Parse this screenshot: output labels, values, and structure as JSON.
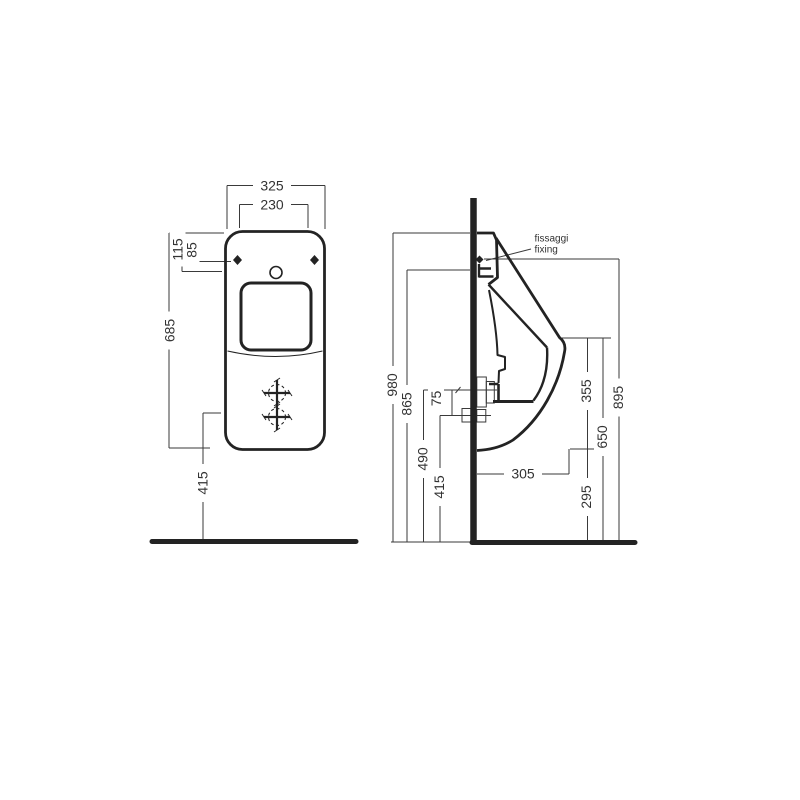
{
  "drawing": {
    "kind": "technical installation drawing",
    "subject": "wall-hung urinal, front and side elevation",
    "background": "#ffffff",
    "line_color": "#232323",
    "dim_line_color": "#3a3a3a"
  },
  "dims": {
    "front": {
      "overall_width": "325",
      "fixing_centers": "230",
      "fixing_offset_1": "115",
      "fixing_offset_2": "85",
      "body_height": "685",
      "outlet_height": "415"
    },
    "side": {
      "overall_height": "980",
      "fixing_height_1": "865",
      "fixing_height_2": "895",
      "inlet_outlet_gap": "75",
      "inlet_height": "490",
      "outlet_height": "415",
      "depth": "305",
      "rim_to_bottom": "355",
      "rim_height": "650",
      "bottom_clearance": "295"
    }
  },
  "labels": {
    "fixing_line1": "fissaggi",
    "fixing_line2": "fixing"
  }
}
